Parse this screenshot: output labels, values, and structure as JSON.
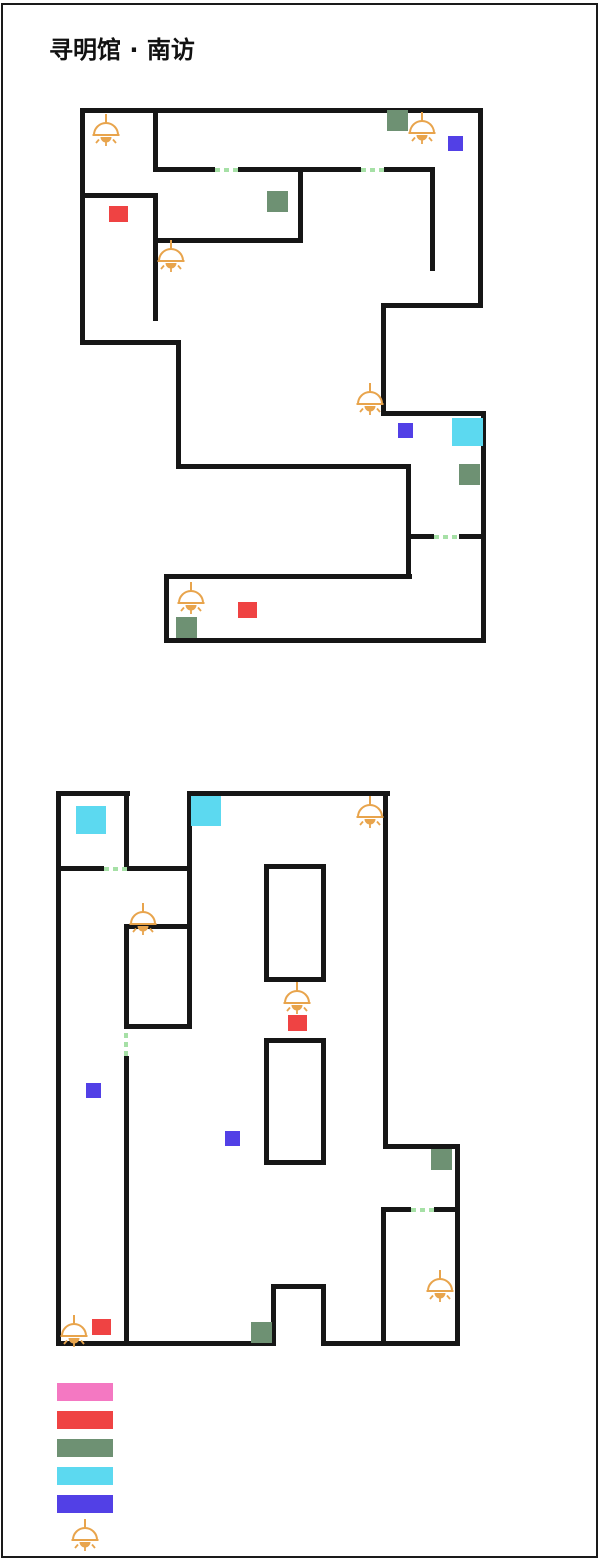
{
  "title": "寻明馆 · 南访",
  "colors": {
    "wall": "#161616",
    "door_dash": "#A6E0A6",
    "door_label": "#8FAD8F",
    "switch_bg": "#6E9173",
    "switch_letter": "#E9F1E9",
    "note": "#EF4343",
    "dialog": "#5240E6",
    "pouch": "#5CD9F0",
    "door_legend": "#F478C2",
    "lamp": "#E8A44C",
    "start_text": "#B33636",
    "watermark": "#E6E4E4"
  },
  "legend": {
    "items": [
      {
        "label": "门",
        "color": "#F478C2"
      },
      {
        "label": "散落的笔记",
        "color": "#EF4343"
      },
      {
        "label": "开关",
        "color": "#6E9173"
      },
      {
        "label": "锦囊",
        "color": "#5CD9F0"
      },
      {
        "label": "特殊对话",
        "color": "#5240E6"
      },
      {
        "label": "灯光",
        "icon": "lamp"
      }
    ]
  },
  "maps": [
    {
      "watermark": {
        "text": "男主",
        "x": 112,
        "y": 126,
        "size": 84
      },
      "walls": [
        [
          80,
          108,
          403,
          5
        ],
        [
          156,
          167,
          59,
          5
        ],
        [
          238,
          167,
          123,
          5
        ],
        [
          384,
          167,
          51,
          5
        ],
        [
          80,
          193,
          78,
          5
        ],
        [
          156,
          238,
          146,
          5
        ],
        [
          383,
          303,
          100,
          5
        ],
        [
          80,
          340,
          100,
          5
        ],
        [
          383,
          411,
          103,
          5
        ],
        [
          178,
          464,
          232,
          5
        ],
        [
          408,
          534,
          26,
          5
        ],
        [
          459,
          534,
          27,
          5
        ],
        [
          166,
          574,
          246,
          5
        ],
        [
          166,
          638,
          320,
          5
        ],
        [
          80,
          108,
          5,
          237
        ],
        [
          153,
          108,
          5,
          64
        ],
        [
          153,
          193,
          5,
          128
        ],
        [
          298,
          167,
          5,
          76
        ],
        [
          430,
          167,
          5,
          104
        ],
        [
          478,
          108,
          5,
          200
        ],
        [
          381,
          303,
          5,
          113
        ],
        [
          481,
          411,
          5,
          232
        ],
        [
          176,
          340,
          5,
          129
        ],
        [
          406,
          464,
          5,
          115
        ],
        [
          164,
          574,
          5,
          69
        ]
      ],
      "pillars": [],
      "doors": [
        {
          "o": "h",
          "x": 215,
          "y": 168,
          "len": 23,
          "label": "B",
          "lx": 210,
          "ly": 138
        },
        {
          "o": "h",
          "x": 361,
          "y": 168,
          "len": 23,
          "label": "C",
          "lx": 359,
          "ly": 136
        },
        {
          "o": "h",
          "x": 434,
          "y": 535,
          "len": 25,
          "label": "D",
          "lx": 432,
          "ly": 508
        }
      ],
      "switches": [
        {
          "x": 387,
          "y": 110,
          "label": "A"
        },
        {
          "x": 267,
          "y": 191,
          "label": "B"
        },
        {
          "x": 459,
          "y": 464,
          "label": "E"
        },
        {
          "x": 176,
          "y": 617,
          "label": "F"
        }
      ],
      "notes": [
        [
          109,
          206
        ],
        [
          238,
          602
        ]
      ],
      "dialogs": [
        [
          448,
          136
        ],
        [
          398,
          423
        ]
      ],
      "pouches": [
        {
          "x": 452,
          "y": 418,
          "w": 31,
          "h": 28
        }
      ],
      "labels": [
        {
          "text": "锦囊",
          "x": 492,
          "y": 419,
          "type": "black"
        },
        {
          "text": "出发点",
          "x": 95,
          "y": 140,
          "type": "start"
        }
      ],
      "lamps": [
        [
          90,
          112
        ],
        [
          406,
          110
        ],
        [
          155,
          238
        ],
        [
          354,
          381
        ],
        [
          175,
          580
        ]
      ]
    },
    {
      "watermark": {
        "text": "我",
        "x": 418,
        "y": 990,
        "size": 88
      },
      "walls": [
        [
          56,
          791,
          74,
          5
        ],
        [
          189,
          791,
          201,
          5
        ],
        [
          56,
          866,
          48,
          5
        ],
        [
          127,
          866,
          64,
          5
        ],
        [
          385,
          1144,
          73,
          5
        ],
        [
          381,
          1207,
          30,
          5
        ],
        [
          434,
          1207,
          26,
          5
        ],
        [
          273,
          1284,
          53,
          5
        ],
        [
          56,
          1341,
          219,
          5
        ],
        [
          324,
          1341,
          136,
          5
        ],
        [
          56,
          791,
          5,
          555
        ],
        [
          124,
          791,
          5,
          80
        ],
        [
          187,
          791,
          5,
          238
        ],
        [
          124,
          1056,
          5,
          290
        ],
        [
          383,
          791,
          5,
          358
        ],
        [
          455,
          1144,
          5,
          202
        ],
        [
          381,
          1207,
          5,
          139
        ],
        [
          271,
          1284,
          5,
          62
        ],
        [
          321,
          1284,
          5,
          62
        ]
      ],
      "pillars": [
        [
          264,
          864,
          62,
          118
        ],
        [
          264,
          1038,
          62,
          127
        ],
        [
          124,
          924,
          68,
          105
        ]
      ],
      "doors": [
        {
          "o": "h",
          "x": 104,
          "y": 867,
          "len": 23,
          "label": "F",
          "lx": 103,
          "ly": 872
        },
        {
          "o": "v",
          "x": 124,
          "y": 1029,
          "len": 27,
          "label": "E",
          "lx": 133,
          "ly": 1030
        },
        {
          "o": "h",
          "x": 411,
          "y": 1208,
          "len": 23,
          "label": "A",
          "lx": 411,
          "ly": 1214
        }
      ],
      "switches": [
        {
          "x": 431,
          "y": 1149,
          "label": "C"
        },
        {
          "x": 251,
          "y": 1322,
          "label": "D"
        }
      ],
      "notes": [
        [
          288,
          1015
        ],
        [
          92,
          1319
        ]
      ],
      "dialogs": [
        [
          86,
          1083
        ],
        [
          225,
          1131
        ]
      ],
      "pouches": [
        {
          "x": 76,
          "y": 806,
          "w": 30,
          "h": 28
        },
        {
          "x": 191,
          "y": 796,
          "w": 30,
          "h": 30
        }
      ],
      "labels": [
        {
          "text": "银币",
          "x": 68,
          "y": 762,
          "type": "black"
        },
        {
          "text": "锦囊",
          "x": 184,
          "y": 762,
          "type": "black"
        },
        {
          "text": "出发点",
          "x": 393,
          "y": 1296,
          "type": "start"
        }
      ],
      "lamps": [
        [
          354,
          794
        ],
        [
          127,
          901
        ],
        [
          281,
          980
        ],
        [
          424,
          1268
        ],
        [
          58,
          1313
        ]
      ]
    }
  ],
  "legend_layout": {
    "x_swatch": 57,
    "x_label": 121,
    "y_start": 1383,
    "row_step": 28
  }
}
